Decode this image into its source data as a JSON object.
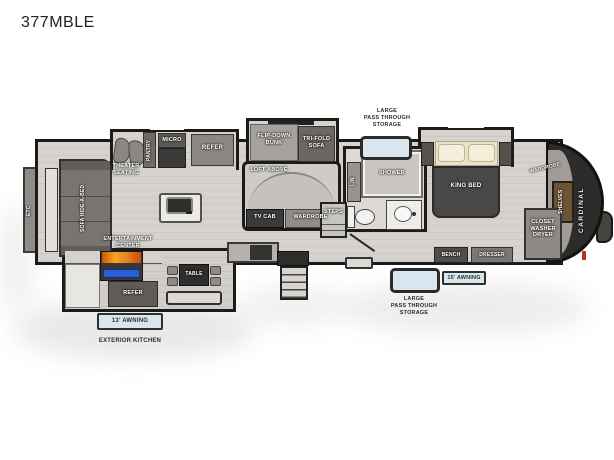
{
  "title": "377MBLE",
  "brand": "CARDINAL",
  "living": {
    "etc": "ETC",
    "sofa": "SOFA HIDE-A-BED",
    "theater": "THEATER\nSEATING",
    "pantry": "PANTRY",
    "micro": "MICRO",
    "refer": "REFER",
    "entertainment": "ENTERTAINMENT\nCENTER"
  },
  "bunkhouse": {
    "flip_down_bunk": "FLIP-DOWN\nBUNK",
    "tri_fold_sofa": "TRI-FOLD\nSOFA",
    "loft_above": "LOFT ABOVE",
    "tv_cab": "TV CAB",
    "wardrobe": "WARDROBE",
    "steps": "STEPS"
  },
  "bath": {
    "lin": "LIN",
    "shower": "SHOWER"
  },
  "bedroom": {
    "king_bed": "KING BED",
    "wardrobe": "WARDROBE",
    "shelves": "SHELVES",
    "closet_washer_dryer": "CLOSET\nWASHER\nDRYER",
    "bench": "BENCH",
    "dresser": "DRESSER"
  },
  "exterior": {
    "pass_through_top": "LARGE\nPASS THROUGH\nSTORAGE",
    "pass_through_bottom": "LARGE\nPASS THROUGH\nSTORAGE",
    "awning_13": "13' AWNING",
    "awning_15": "15' AWNING",
    "exterior_kitchen": "EXTERIOR KITCHEN",
    "table": "TABLE",
    "refer": "REFER"
  },
  "colors": {
    "wall": "#1c1b1a",
    "storage_blue": "#d7e6ef",
    "flame_orange": "#e0761f",
    "oven_blue": "#2b5fd9",
    "accent_red": "#b5342c"
  }
}
